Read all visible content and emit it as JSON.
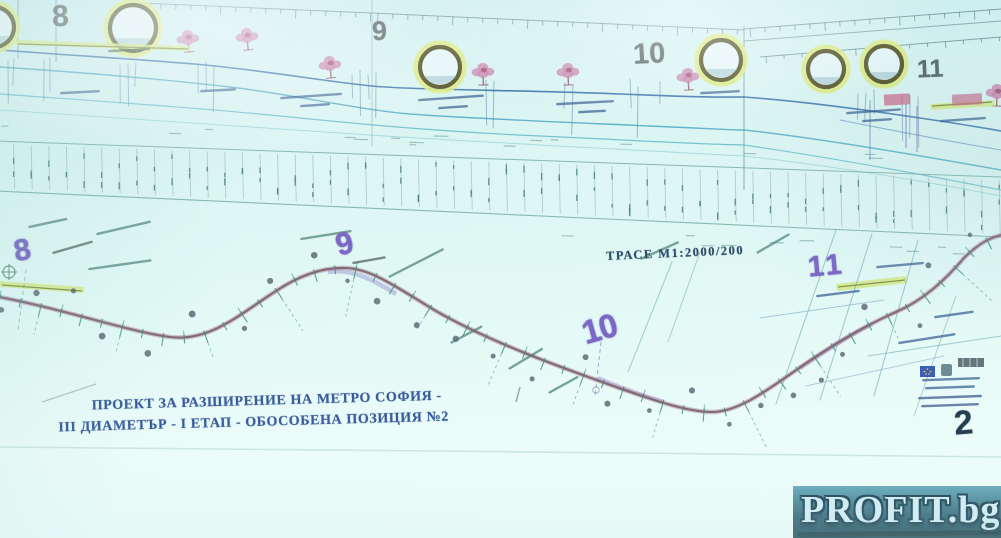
{
  "drawing": {
    "profile_station_numbers": [
      "8",
      "9",
      "10",
      "11"
    ],
    "plan_station_numbers": [
      "8",
      "9",
      "10",
      "11"
    ],
    "plan_scale_label": "ТРАСЕ М1:2000/200",
    "title_line1": "ПРОЕКТ ЗА РАЗШИРЕНИЕ НА МЕТРО СОФИЯ -",
    "title_line2": "III ДИАМЕТЪР - I ЕТАП - ОБОСОБЕНА ПОЗИЦИЯ №2",
    "sheet_number": "2"
  },
  "watermark": {
    "text": "PROFIT.bg"
  },
  "colors": {
    "route_line": "#7d5f6e",
    "plan_station_number": "#7b68c6",
    "platform_highlight": "#d4e87e",
    "profile_ground_line": "#2f66a8",
    "watermark_band": "#17404f"
  }
}
